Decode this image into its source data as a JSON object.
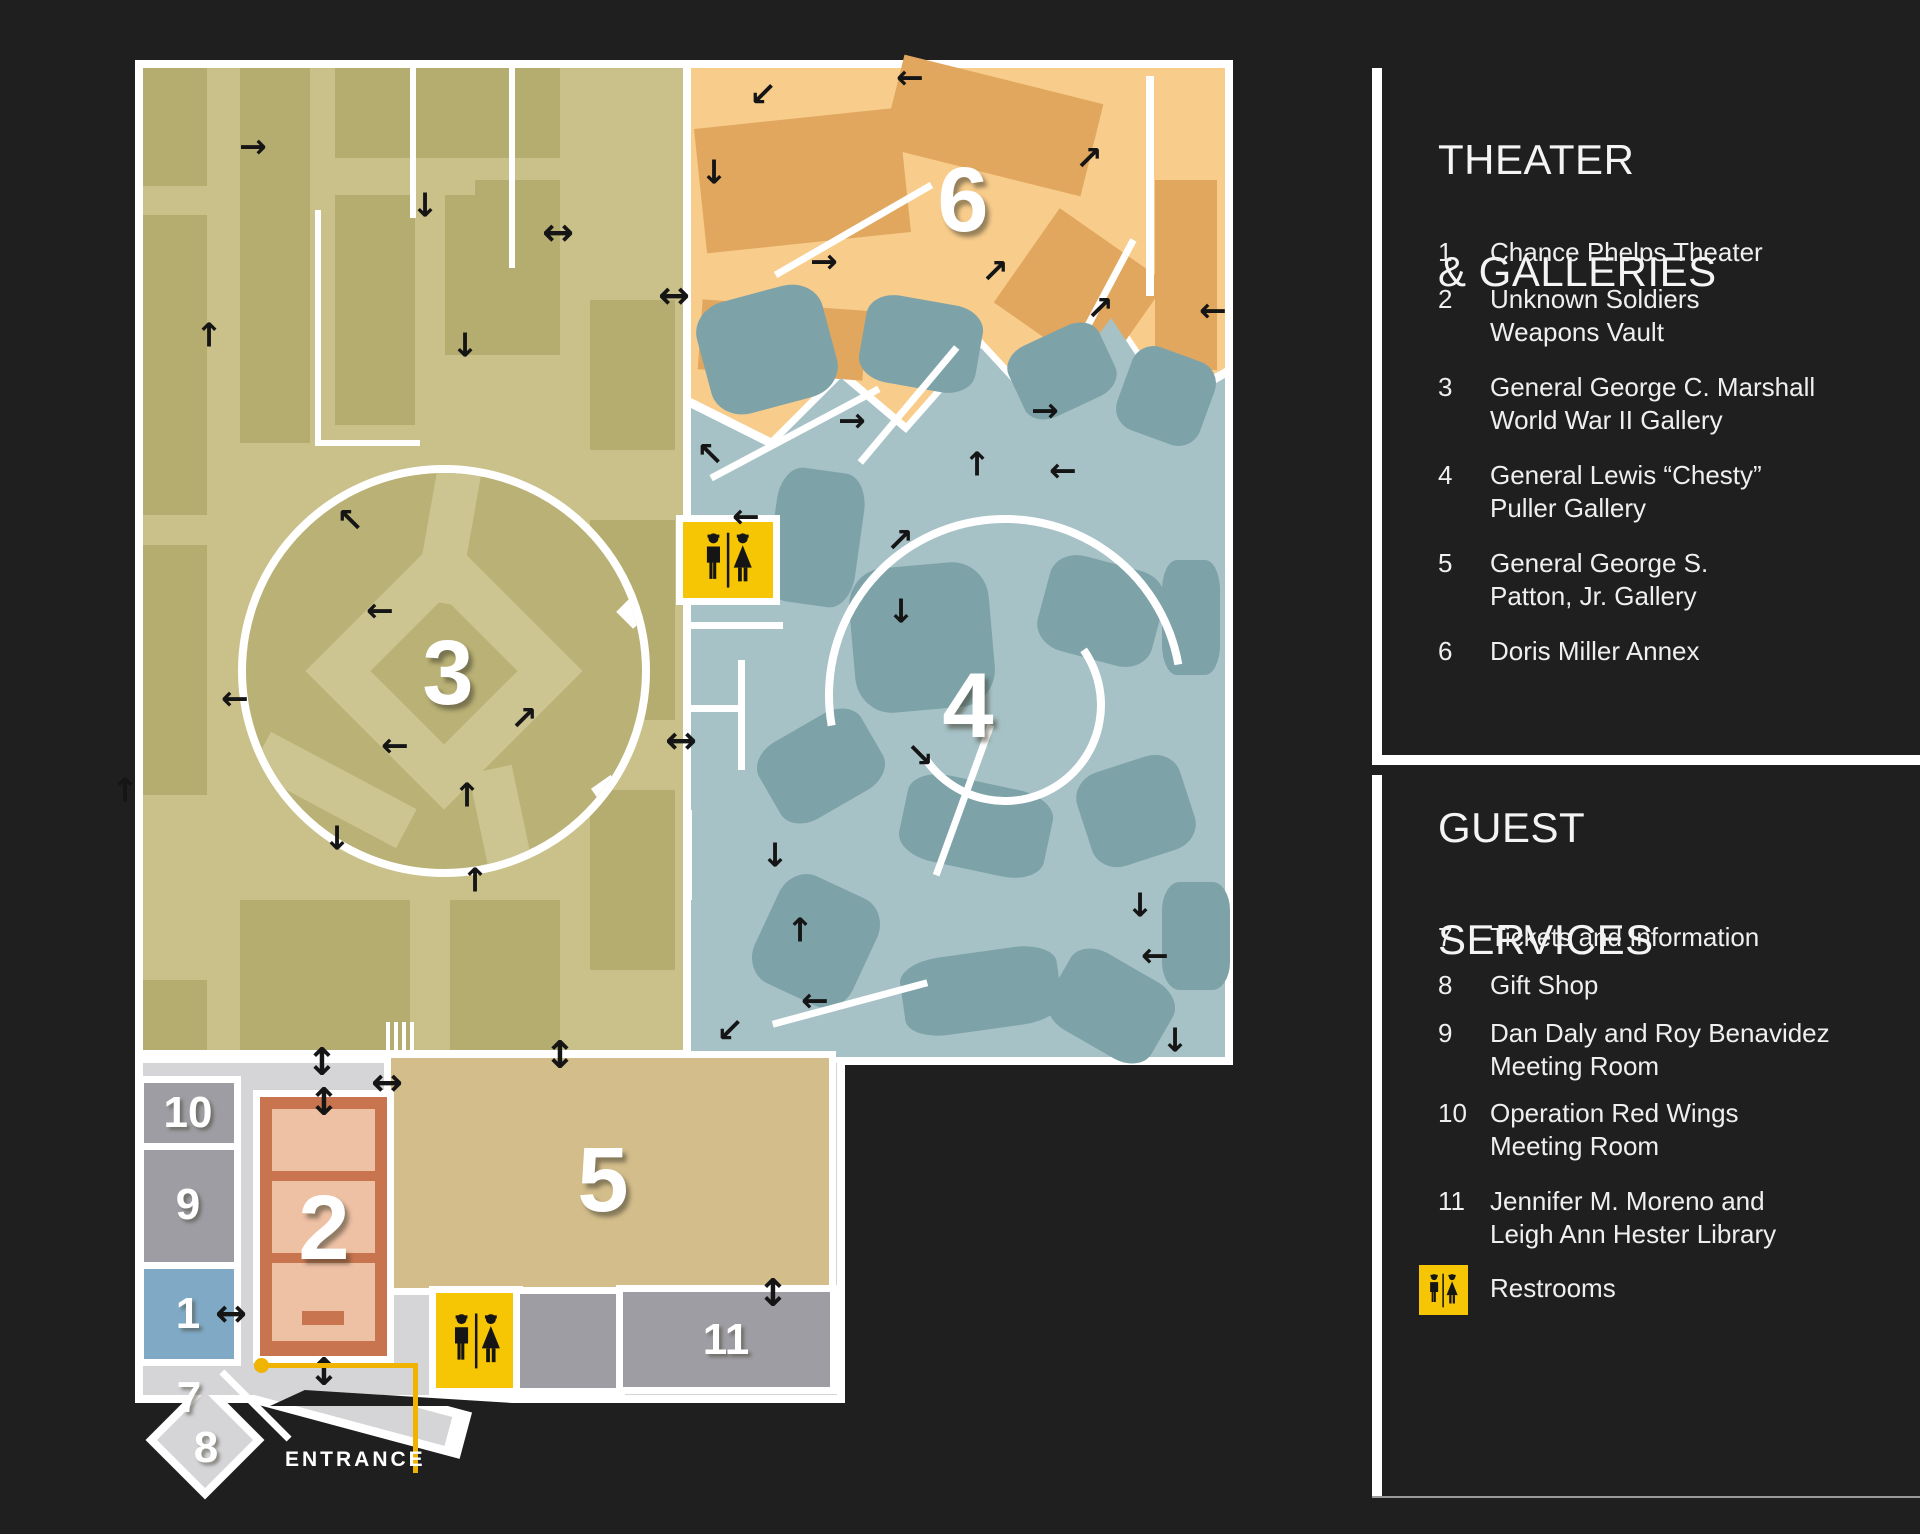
{
  "map": {
    "entrance_label": "ENTRANCE",
    "markers": [
      {
        "label": "1"
      },
      {
        "label": "2"
      },
      {
        "label": "3"
      },
      {
        "label": "4"
      },
      {
        "label": "5"
      },
      {
        "label": "6"
      },
      {
        "label": "7"
      },
      {
        "label": "8"
      },
      {
        "label": "9"
      },
      {
        "label": "10"
      },
      {
        "label": "11"
      }
    ]
  },
  "legend": {
    "theater_galleries": {
      "title_line1": "THEATER",
      "title_line2": "& GALLERIES",
      "items": [
        {
          "number": "1",
          "name": "Chance Phelps Theater"
        },
        {
          "number": "2",
          "name": "Unknown Soldiers\nWeapons Vault"
        },
        {
          "number": "3",
          "name": "General George C. Marshall\nWorld War II Gallery"
        },
        {
          "number": "4",
          "name": "General Lewis “Chesty”\nPuller Gallery"
        },
        {
          "number": "5",
          "name": "General George S.\nPatton, Jr. Gallery"
        },
        {
          "number": "6",
          "name": "Doris Miller Annex"
        }
      ]
    },
    "guest_services": {
      "title_line1": "GUEST",
      "title_line2": "SERVICES",
      "items": [
        {
          "number": "7",
          "name": "Tickets and Information"
        },
        {
          "number": "8",
          "name": "Gift Shop"
        },
        {
          "number": "9",
          "name": "Dan Daly and Roy Benavidez\nMeeting Room"
        },
        {
          "number": "10",
          "name": "Operation Red Wings\nMeeting Room"
        },
        {
          "number": "11",
          "name": "Jennifer M. Moreno and\nLeigh Ann Hester Library"
        }
      ],
      "restrooms_label": "Restrooms"
    }
  },
  "colors": {
    "background": "#1f1f1f",
    "map_white": "#ffffff",
    "gallery3_olive": "#c9c189",
    "gallery3_olive_dark": "#b5ad6f",
    "annex6_orange": "#f8cc8b",
    "annex6_orange_dark": "#e1a75f",
    "gallery4_blue": "#a6c2c6",
    "gallery4_blue_dark": "#7da2a8",
    "gallery5_tan": "#d3bd8b",
    "vault2_salmon": "#c8744f",
    "vault2_salmon_light": "#eec0a4",
    "lobby_gray": "#d5d4d7",
    "room_gray": "#9e9da3",
    "theater1_blue": "#7fa9c4",
    "restroom_yellow": "#f6c605",
    "entrance_accent": "#f0b400",
    "legend_text": "#efefef"
  }
}
